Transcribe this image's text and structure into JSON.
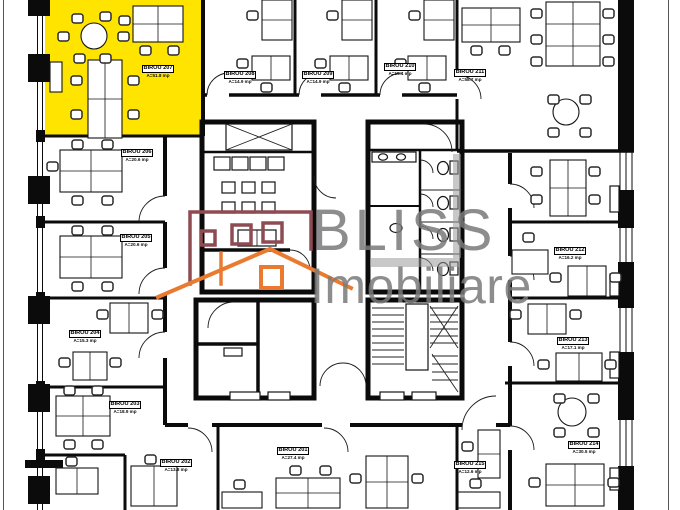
{
  "plan": {
    "highlight_color": "#ffe400",
    "wall_color": "#0b0b0b",
    "background": "#ffffff"
  },
  "watermark": {
    "brand": "BLISS",
    "suffix": "Imobiliare",
    "text_color": "#7a7a7a",
    "house_outline_color": "#8e4b52",
    "roof_color": "#ea7a30"
  },
  "rooms": [
    {
      "id": "207",
      "label": "BIROU 207",
      "area": "A=51.8 mp",
      "highlighted": true
    },
    {
      "id": "206",
      "label": "BIROU 206",
      "area": "A=20.6 mp"
    },
    {
      "id": "205",
      "label": "BIROU 205",
      "area": "A=20.6 mp"
    },
    {
      "id": "204",
      "label": "BIROU 204",
      "area": "A=15.3 mp"
    },
    {
      "id": "203",
      "label": "BIROU 203",
      "area": "A=18.9 mp"
    },
    {
      "id": "202",
      "label": "BIROU 202",
      "area": "A=13.8 mp"
    },
    {
      "id": "201",
      "label": "BIROU 201",
      "area": "A=27.4 mp"
    },
    {
      "id": "208",
      "label": "BIROU 208",
      "area": "A=14.9 mp"
    },
    {
      "id": "209",
      "label": "BIROU 209",
      "area": "A=14.9 mp"
    },
    {
      "id": "210",
      "label": "BIROU 210",
      "area": "A=15.4 mp"
    },
    {
      "id": "211",
      "label": "BIROU 211",
      "area": "A=58.7 mp"
    },
    {
      "id": "212",
      "label": "BIROU 212",
      "area": "A=16.2 mp"
    },
    {
      "id": "213",
      "label": "BIROU 213",
      "area": "A=17.1 mp"
    },
    {
      "id": "214",
      "label": "BIROU 214",
      "area": "A=30.5 mp"
    },
    {
      "id": "215",
      "label": "BIROU 215",
      "area": "A=12.6 mp"
    }
  ]
}
